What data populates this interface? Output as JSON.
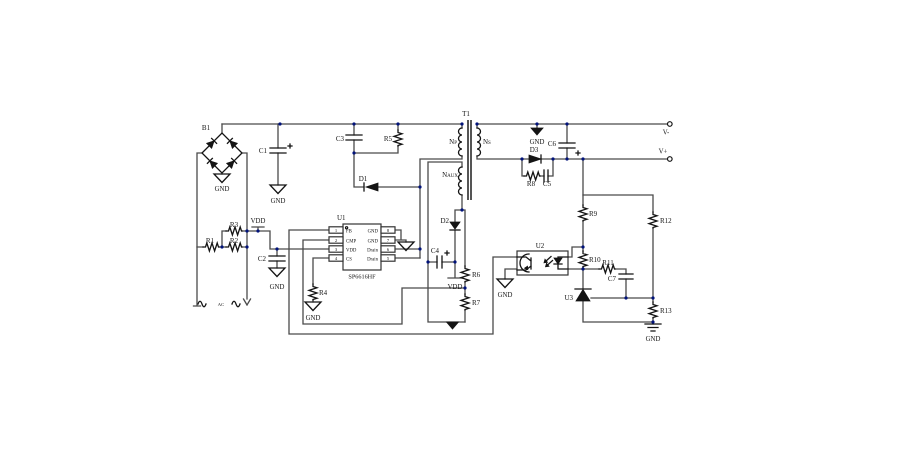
{
  "schematic": {
    "refs": {
      "b1": "B1",
      "t1": "T1",
      "u1": "U1",
      "u2": "U2",
      "u3": "U3",
      "r1": "R1",
      "r2": "R2",
      "r3": "R3",
      "r4": "R4",
      "r5": "R5",
      "r6": "R6",
      "r7": "R7",
      "r8": "R8",
      "r9": "R9",
      "r10": "R10",
      "r11": "R11",
      "r12": "R12",
      "r13": "R13",
      "c1": "C1",
      "c2": "C2",
      "c3": "C3",
      "c4": "C4",
      "c5": "C5",
      "c6": "C6",
      "c7": "C7",
      "d1": "D1",
      "d2": "D2",
      "d3": "D3"
    },
    "nets": {
      "gnd": "GND",
      "vdd": "VDD",
      "ac": "AC",
      "v_plus": "V+",
      "v_minus": "V-"
    },
    "windings": {
      "primary": "Np",
      "secondary": "Ns",
      "aux": "Naux"
    },
    "ic": {
      "part": "SP6616HF",
      "left_pins": [
        {
          "num": "1",
          "name": "FB"
        },
        {
          "num": "2",
          "name": "CMP"
        },
        {
          "num": "3",
          "name": "VDD"
        },
        {
          "num": "4",
          "name": "CS"
        }
      ],
      "right_pins": [
        {
          "num": "8",
          "name": "GND"
        },
        {
          "num": "7",
          "name": "GND"
        },
        {
          "num": "6",
          "name": "Drain"
        },
        {
          "num": "5",
          "name": "Drain"
        }
      ]
    }
  }
}
